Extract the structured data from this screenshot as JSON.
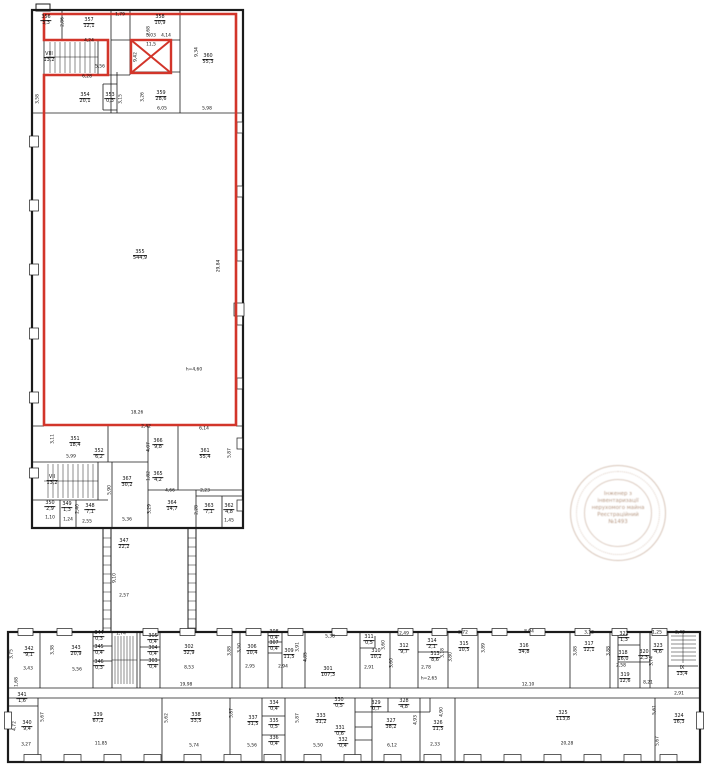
{
  "colors": {
    "highlight_red": "#d2352a",
    "wall_black": "#1b1b1b",
    "stamp_brown": "#986848"
  },
  "stamp": {
    "lines": [
      "Інженер з",
      "інвентаризації",
      "нерухомого майна",
      "Реєстраційний",
      "№1493"
    ]
  },
  "plan": {
    "labels": [
      {
        "t": "356\n3,3",
        "x": 46,
        "y": 21,
        "r": 1
      },
      {
        "t": "357\n12,1",
        "x": 89,
        "y": 24,
        "r": 1
      },
      {
        "t": "358\n10,9",
        "x": 160,
        "y": 21,
        "r": 1
      },
      {
        "t": "3,03",
        "x": 151,
        "y": 37
      },
      {
        "t": "11,5",
        "x": 151,
        "y": 46
      },
      {
        "t": "360\n55,3",
        "x": 208,
        "y": 60,
        "r": 1
      },
      {
        "t": "VIII\n13,2",
        "x": 49,
        "y": 58,
        "r": 1
      },
      {
        "t": "354\n20,1",
        "x": 85,
        "y": 99,
        "r": 1
      },
      {
        "t": "353\n0,3",
        "x": 110,
        "y": 99,
        "r": 1
      },
      {
        "t": "359\n28,6",
        "x": 161,
        "y": 97,
        "r": 1
      },
      {
        "t": "1,79",
        "x": 120,
        "y": 16
      },
      {
        "t": "2,86",
        "x": 64,
        "y": 22,
        "rot": 1
      },
      {
        "t": "4,24",
        "x": 89,
        "y": 42
      },
      {
        "t": "2,68",
        "x": 150,
        "y": 31,
        "rot": 1
      },
      {
        "t": "4,14",
        "x": 166,
        "y": 37
      },
      {
        "t": "9,42",
        "x": 137,
        "y": 57,
        "rot": 1
      },
      {
        "t": "9,34",
        "x": 198,
        "y": 52,
        "rot": 1
      },
      {
        "t": "5,56",
        "x": 100,
        "y": 68
      },
      {
        "t": "6,28",
        "x": 87,
        "y": 78
      },
      {
        "t": "3,58",
        "x": 39,
        "y": 99,
        "rot": 1
      },
      {
        "t": "3,15",
        "x": 122,
        "y": 99,
        "rot": 1
      },
      {
        "t": "3,26",
        "x": 144,
        "y": 97,
        "rot": 1
      },
      {
        "t": "6,05",
        "x": 162,
        "y": 110
      },
      {
        "t": "5,98",
        "x": 207,
        "y": 110
      },
      {
        "t": "355\n544,9",
        "x": 140,
        "y": 256,
        "r": 1
      },
      {
        "t": "h=4,60",
        "x": 194,
        "y": 371
      },
      {
        "t": "18,26",
        "x": 137,
        "y": 414
      },
      {
        "t": "29,84",
        "x": 220,
        "y": 266,
        "rot": 1
      },
      {
        "t": "351\n18,4",
        "x": 75,
        "y": 443,
        "r": 1
      },
      {
        "t": "352\n6,2",
        "x": 99,
        "y": 455,
        "r": 1
      },
      {
        "t": "366\n9,8",
        "x": 158,
        "y": 445,
        "r": 1
      },
      {
        "t": "361\n55,4",
        "x": 205,
        "y": 455,
        "r": 1
      },
      {
        "t": "365\n4,2",
        "x": 158,
        "y": 478,
        "r": 1
      },
      {
        "t": "367\n30,2",
        "x": 127,
        "y": 483,
        "r": 1
      },
      {
        "t": "VII\n13,2",
        "x": 52,
        "y": 481,
        "r": 1
      },
      {
        "t": "350\n2,9",
        "x": 50,
        "y": 507,
        "r": 1
      },
      {
        "t": "349\n1,3",
        "x": 67,
        "y": 508,
        "r": 1
      },
      {
        "t": "348\n7,1",
        "x": 90,
        "y": 510,
        "r": 1
      },
      {
        "t": "364\n14,7",
        "x": 172,
        "y": 507,
        "r": 1
      },
      {
        "t": "363\n7,1",
        "x": 209,
        "y": 510,
        "r": 1
      },
      {
        "t": "362\n4,8",
        "x": 229,
        "y": 510,
        "r": 1
      },
      {
        "t": "347\n22,2",
        "x": 124,
        "y": 545,
        "r": 1
      },
      {
        "t": "3,11",
        "x": 54,
        "y": 439,
        "rot": 1
      },
      {
        "t": "5,99",
        "x": 71,
        "y": 458
      },
      {
        "t": "2,42",
        "x": 146,
        "y": 428
      },
      {
        "t": "4,07",
        "x": 150,
        "y": 447,
        "rot": 1
      },
      {
        "t": "6,14",
        "x": 204,
        "y": 430
      },
      {
        "t": "5,87",
        "x": 231,
        "y": 453,
        "rot": 1
      },
      {
        "t": "1,82",
        "x": 150,
        "y": 476,
        "rot": 1
      },
      {
        "t": "2,40",
        "x": 79,
        "y": 509,
        "rot": 1
      },
      {
        "t": "1,10",
        "x": 50,
        "y": 519
      },
      {
        "t": "1,24",
        "x": 68,
        "y": 521
      },
      {
        "t": "2,55",
        "x": 87,
        "y": 523
      },
      {
        "t": "4,66",
        "x": 170,
        "y": 492
      },
      {
        "t": "2,23",
        "x": 205,
        "y": 492
      },
      {
        "t": "3,29",
        "x": 151,
        "y": 509,
        "rot": 1
      },
      {
        "t": "2,28",
        "x": 198,
        "y": 510,
        "rot": 1
      },
      {
        "t": "1,45",
        "x": 229,
        "y": 522
      },
      {
        "t": "5,36",
        "x": 127,
        "y": 521
      },
      {
        "t": "5,90",
        "x": 111,
        "y": 490,
        "rot": 1
      },
      {
        "t": "9,10",
        "x": 116,
        "y": 578,
        "rot": 1
      },
      {
        "t": "2,57",
        "x": 124,
        "y": 597
      },
      {
        "t": "342\n9,1",
        "x": 29,
        "y": 653,
        "r": 1
      },
      {
        "t": "343\n20,9",
        "x": 76,
        "y": 652,
        "r": 1
      },
      {
        "t": "344\n0,3",
        "x": 99,
        "y": 637,
        "r": 1
      },
      {
        "t": "345\n0,4",
        "x": 99,
        "y": 651,
        "r": 1
      },
      {
        "t": "346\n0,3",
        "x": 99,
        "y": 666,
        "r": 1
      },
      {
        "t": "305\n0,4",
        "x": 153,
        "y": 640,
        "r": 1
      },
      {
        "t": "304\n0,4",
        "x": 153,
        "y": 652,
        "r": 1
      },
      {
        "t": "303\n0,4",
        "x": 153,
        "y": 665,
        "r": 1
      },
      {
        "t": "302\n32,9",
        "x": 189,
        "y": 651,
        "r": 1
      },
      {
        "t": "306\n10,4",
        "x": 252,
        "y": 651,
        "r": 1
      },
      {
        "t": "308\n0,4",
        "x": 274,
        "y": 636,
        "r": 1
      },
      {
        "t": "307\n0,4",
        "x": 274,
        "y": 647,
        "r": 1
      },
      {
        "t": "309\n11,5",
        "x": 289,
        "y": 655,
        "r": 1
      },
      {
        "t": "301\n107,3",
        "x": 328,
        "y": 673,
        "r": 1
      },
      {
        "t": "311\n0,5",
        "x": 369,
        "y": 641,
        "r": 1
      },
      {
        "t": "310\n10,2",
        "x": 376,
        "y": 655,
        "r": 1
      },
      {
        "t": "312\n9,7",
        "x": 404,
        "y": 650,
        "r": 1
      },
      {
        "t": "314\n2,1",
        "x": 432,
        "y": 645,
        "r": 1
      },
      {
        "t": "313\n8,6",
        "x": 435,
        "y": 658,
        "r": 1
      },
      {
        "t": "315\n10,5",
        "x": 464,
        "y": 648,
        "r": 1
      },
      {
        "t": "316\n34,8",
        "x": 524,
        "y": 650,
        "r": 1
      },
      {
        "t": "317\n12,1",
        "x": 589,
        "y": 648,
        "r": 1
      },
      {
        "t": "322\n1,3",
        "x": 624,
        "y": 638,
        "r": 1
      },
      {
        "t": "318\n16,0",
        "x": 623,
        "y": 657,
        "r": 1
      },
      {
        "t": "320\n2,3",
        "x": 644,
        "y": 656,
        "r": 1
      },
      {
        "t": "323\n4,6",
        "x": 658,
        "y": 650,
        "r": 1
      },
      {
        "t": "319\n12,6",
        "x": 625,
        "y": 679,
        "r": 1
      },
      {
        "t": "IX\n13,4",
        "x": 682,
        "y": 672,
        "r": 1
      },
      {
        "t": "3,75",
        "x": 13,
        "y": 654,
        "rot": 1
      },
      {
        "t": "3,43",
        "x": 28,
        "y": 670
      },
      {
        "t": "3,38",
        "x": 54,
        "y": 650,
        "rot": 1
      },
      {
        "t": "5,56",
        "x": 77,
        "y": 671
      },
      {
        "t": "1,74",
        "x": 121,
        "y": 635
      },
      {
        "t": "8,53",
        "x": 189,
        "y": 669
      },
      {
        "t": "3,88",
        "x": 231,
        "y": 651,
        "rot": 1
      },
      {
        "t": "19,98",
        "x": 186,
        "y": 686
      },
      {
        "t": "1,68",
        "x": 18,
        "y": 682,
        "rot": 1
      },
      {
        "t": "2,95",
        "x": 250,
        "y": 668
      },
      {
        "t": "3,50",
        "x": 241,
        "y": 648,
        "rot": 1
      },
      {
        "t": "2,94",
        "x": 283,
        "y": 668
      },
      {
        "t": "3,91",
        "x": 299,
        "y": 647,
        "rot": 1
      },
      {
        "t": "4,85",
        "x": 307,
        "y": 657,
        "rot": 1
      },
      {
        "t": "5,38",
        "x": 330,
        "y": 638
      },
      {
        "t": "2,91",
        "x": 369,
        "y": 669
      },
      {
        "t": "3,60",
        "x": 385,
        "y": 645,
        "rot": 1
      },
      {
        "t": "2,49",
        "x": 404,
        "y": 635
      },
      {
        "t": "3,60",
        "x": 393,
        "y": 663,
        "rot": 1
      },
      {
        "t": "2,78",
        "x": 426,
        "y": 669
      },
      {
        "t": "3,18",
        "x": 444,
        "y": 653,
        "rot": 1
      },
      {
        "t": "h=2,65",
        "x": 429,
        "y": 680
      },
      {
        "t": "2,72",
        "x": 463,
        "y": 634
      },
      {
        "t": "3,80",
        "x": 452,
        "y": 657,
        "rot": 1
      },
      {
        "t": "8,94",
        "x": 529,
        "y": 633
      },
      {
        "t": "3,89",
        "x": 485,
        "y": 648,
        "rot": 1
      },
      {
        "t": "3,12",
        "x": 589,
        "y": 634
      },
      {
        "t": "3,88",
        "x": 577,
        "y": 651,
        "rot": 1
      },
      {
        "t": "3,88",
        "x": 610,
        "y": 651,
        "rot": 1
      },
      {
        "t": "2,58",
        "x": 621,
        "y": 667
      },
      {
        "t": "1,25",
        "x": 657,
        "y": 634
      },
      {
        "t": "2,40",
        "x": 680,
        "y": 634
      },
      {
        "t": "3,74",
        "x": 653,
        "y": 661,
        "rot": 1
      },
      {
        "t": "12,10",
        "x": 528,
        "y": 686
      },
      {
        "t": "8,21",
        "x": 648,
        "y": 684
      },
      {
        "t": "341\n1,6",
        "x": 22,
        "y": 699,
        "r": 1
      },
      {
        "t": "340\n9,4",
        "x": 27,
        "y": 727,
        "r": 1
      },
      {
        "t": "339\n67,2",
        "x": 98,
        "y": 719,
        "r": 1
      },
      {
        "t": "338\n33,5",
        "x": 196,
        "y": 719,
        "r": 1
      },
      {
        "t": "337\n31,5",
        "x": 253,
        "y": 722,
        "r": 1
      },
      {
        "t": "334\n0,4",
        "x": 274,
        "y": 707,
        "r": 1
      },
      {
        "t": "335\n0,5",
        "x": 274,
        "y": 725,
        "r": 1
      },
      {
        "t": "336\n0,4",
        "x": 274,
        "y": 742,
        "r": 1
      },
      {
        "t": "333\n31,2",
        "x": 321,
        "y": 720,
        "r": 1
      },
      {
        "t": "330\n0,5",
        "x": 339,
        "y": 704,
        "r": 1
      },
      {
        "t": "331\n0,6",
        "x": 340,
        "y": 732,
        "r": 1
      },
      {
        "t": "332\n0,4",
        "x": 343,
        "y": 744,
        "r": 1
      },
      {
        "t": "329\n0,7",
        "x": 376,
        "y": 707,
        "r": 1
      },
      {
        "t": "328\n4,8",
        "x": 404,
        "y": 705,
        "r": 1
      },
      {
        "t": "327\n38,2",
        "x": 391,
        "y": 725,
        "r": 1
      },
      {
        "t": "326\n11,5",
        "x": 438,
        "y": 727,
        "r": 1
      },
      {
        "t": "325\n113,8",
        "x": 563,
        "y": 717,
        "r": 1
      },
      {
        "t": "324\n16,3",
        "x": 679,
        "y": 720,
        "r": 1
      },
      {
        "t": "4,72",
        "x": 16,
        "y": 726,
        "rot": 1
      },
      {
        "t": "3,27",
        "x": 26,
        "y": 746
      },
      {
        "t": "5,67",
        "x": 44,
        "y": 717,
        "rot": 1
      },
      {
        "t": "11,85",
        "x": 101,
        "y": 745
      },
      {
        "t": "5,62",
        "x": 168,
        "y": 718,
        "rot": 1
      },
      {
        "t": "5,74",
        "x": 194,
        "y": 747
      },
      {
        "t": "5,87",
        "x": 233,
        "y": 713,
        "rot": 1
      },
      {
        "t": "5,56",
        "x": 252,
        "y": 747
      },
      {
        "t": "5,87",
        "x": 299,
        "y": 718,
        "rot": 1
      },
      {
        "t": "5,50",
        "x": 318,
        "y": 747
      },
      {
        "t": "6,12",
        "x": 392,
        "y": 747
      },
      {
        "t": "4,93",
        "x": 417,
        "y": 720,
        "rot": 1
      },
      {
        "t": "2,33",
        "x": 435,
        "y": 746
      },
      {
        "t": "4,90",
        "x": 443,
        "y": 712,
        "rot": 1
      },
      {
        "t": "20,28",
        "x": 567,
        "y": 745
      },
      {
        "t": "5,61",
        "x": 656,
        "y": 710,
        "rot": 1
      },
      {
        "t": "5,67",
        "x": 659,
        "y": 741,
        "rot": 1
      },
      {
        "t": "2,91",
        "x": 679,
        "y": 695
      }
    ]
  }
}
